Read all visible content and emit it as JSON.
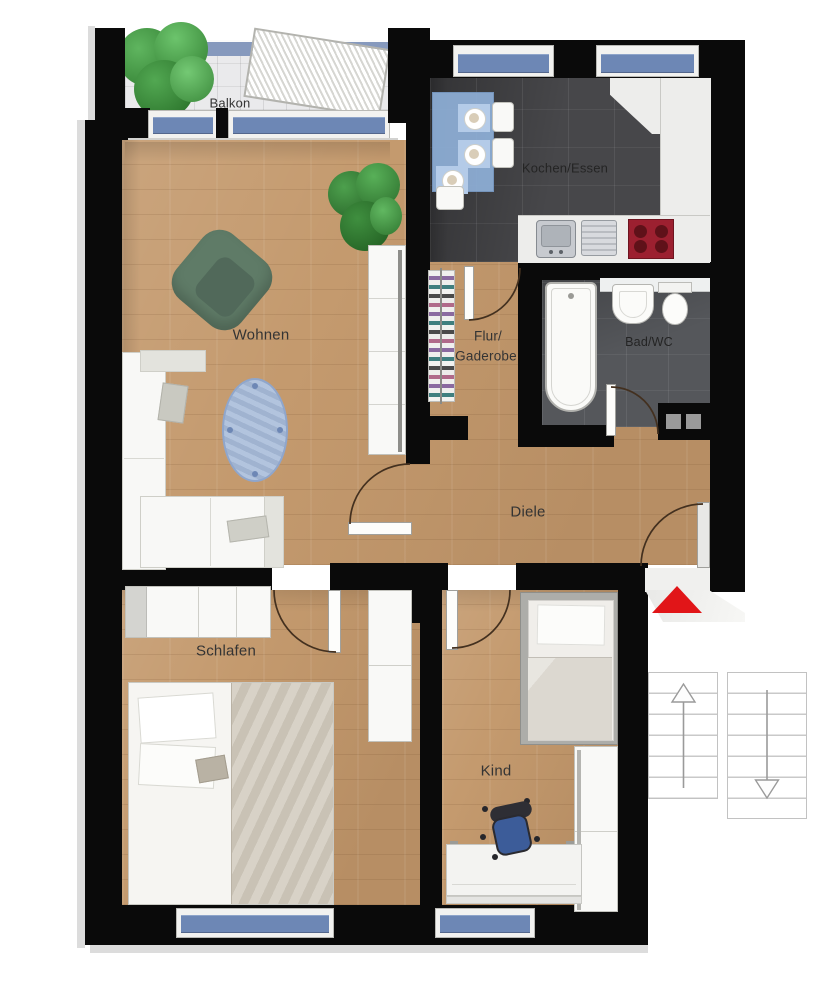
{
  "title": "Apartment floor plan",
  "rooms": {
    "balkon": {
      "label": "Balkon"
    },
    "kochen_essen": {
      "label": "Kochen/Essen"
    },
    "flur_garderobe": {
      "label_line1": "Flur/",
      "label_line2": "Gaderobe"
    },
    "bad_wc": {
      "label": "Bad/WC"
    },
    "wohnen": {
      "label": "Wohnen"
    },
    "diele": {
      "label": "Diele"
    },
    "schlafen": {
      "label": "Schlafen"
    },
    "kind": {
      "label": "Kind"
    }
  },
  "markers": {
    "entrance_arrow": "red-triangle-up",
    "stair_up_arrow": "up",
    "stair_down_arrow": "down"
  },
  "colors": {
    "wall": "#0a0a0a",
    "wood_floor": "#c49a6e",
    "dark_tile": "#47474a",
    "balcony_tile": "#eaeaec",
    "window_glass": "#6d87b5",
    "entrance_arrow": "#e11518",
    "kitchen_table_blue": "#8fb0d8",
    "hob_red": "#9c2030",
    "sofa_white": "#f7f6f3",
    "armchair_green": "#5f7b67",
    "rug_blue": "#a6bad8",
    "plant_green": "#3c8a3c"
  }
}
